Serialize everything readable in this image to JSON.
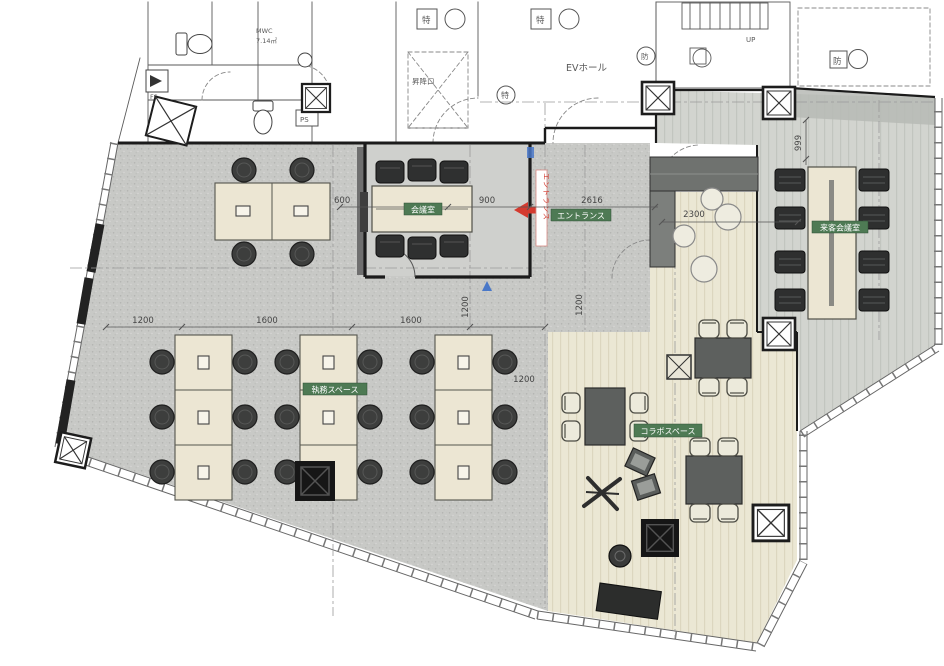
{
  "plan": {
    "rooms": {
      "meeting_room": "会議室",
      "entrance": "エントランス",
      "work_space": "執務スペース",
      "collab_space": "コラボスペース",
      "guest_meeting_room": "来客会議室",
      "ev_hall": "EVホール",
      "hoistway": "昇降口"
    },
    "core": {
      "wc_name": "MWC",
      "wc_area": "7.14㎡",
      "ps": "PS",
      "fs": "FS",
      "up": "UP",
      "fixture_toku": "特",
      "fixture_bou": "防"
    },
    "entrance_sign": "エントランス",
    "dimensions": [
      "600",
      "900",
      "2616",
      "2300",
      "999",
      "1200",
      "1600",
      "1600",
      "1200",
      "1200",
      "1200"
    ]
  },
  "colors": {
    "badge_green": "#4e7a54",
    "carpet_gray": "#c8c9c6",
    "wood_cream": "#ebe7d4",
    "accent_red": "#d43a2f",
    "accent_blue": "#4a78c8"
  }
}
